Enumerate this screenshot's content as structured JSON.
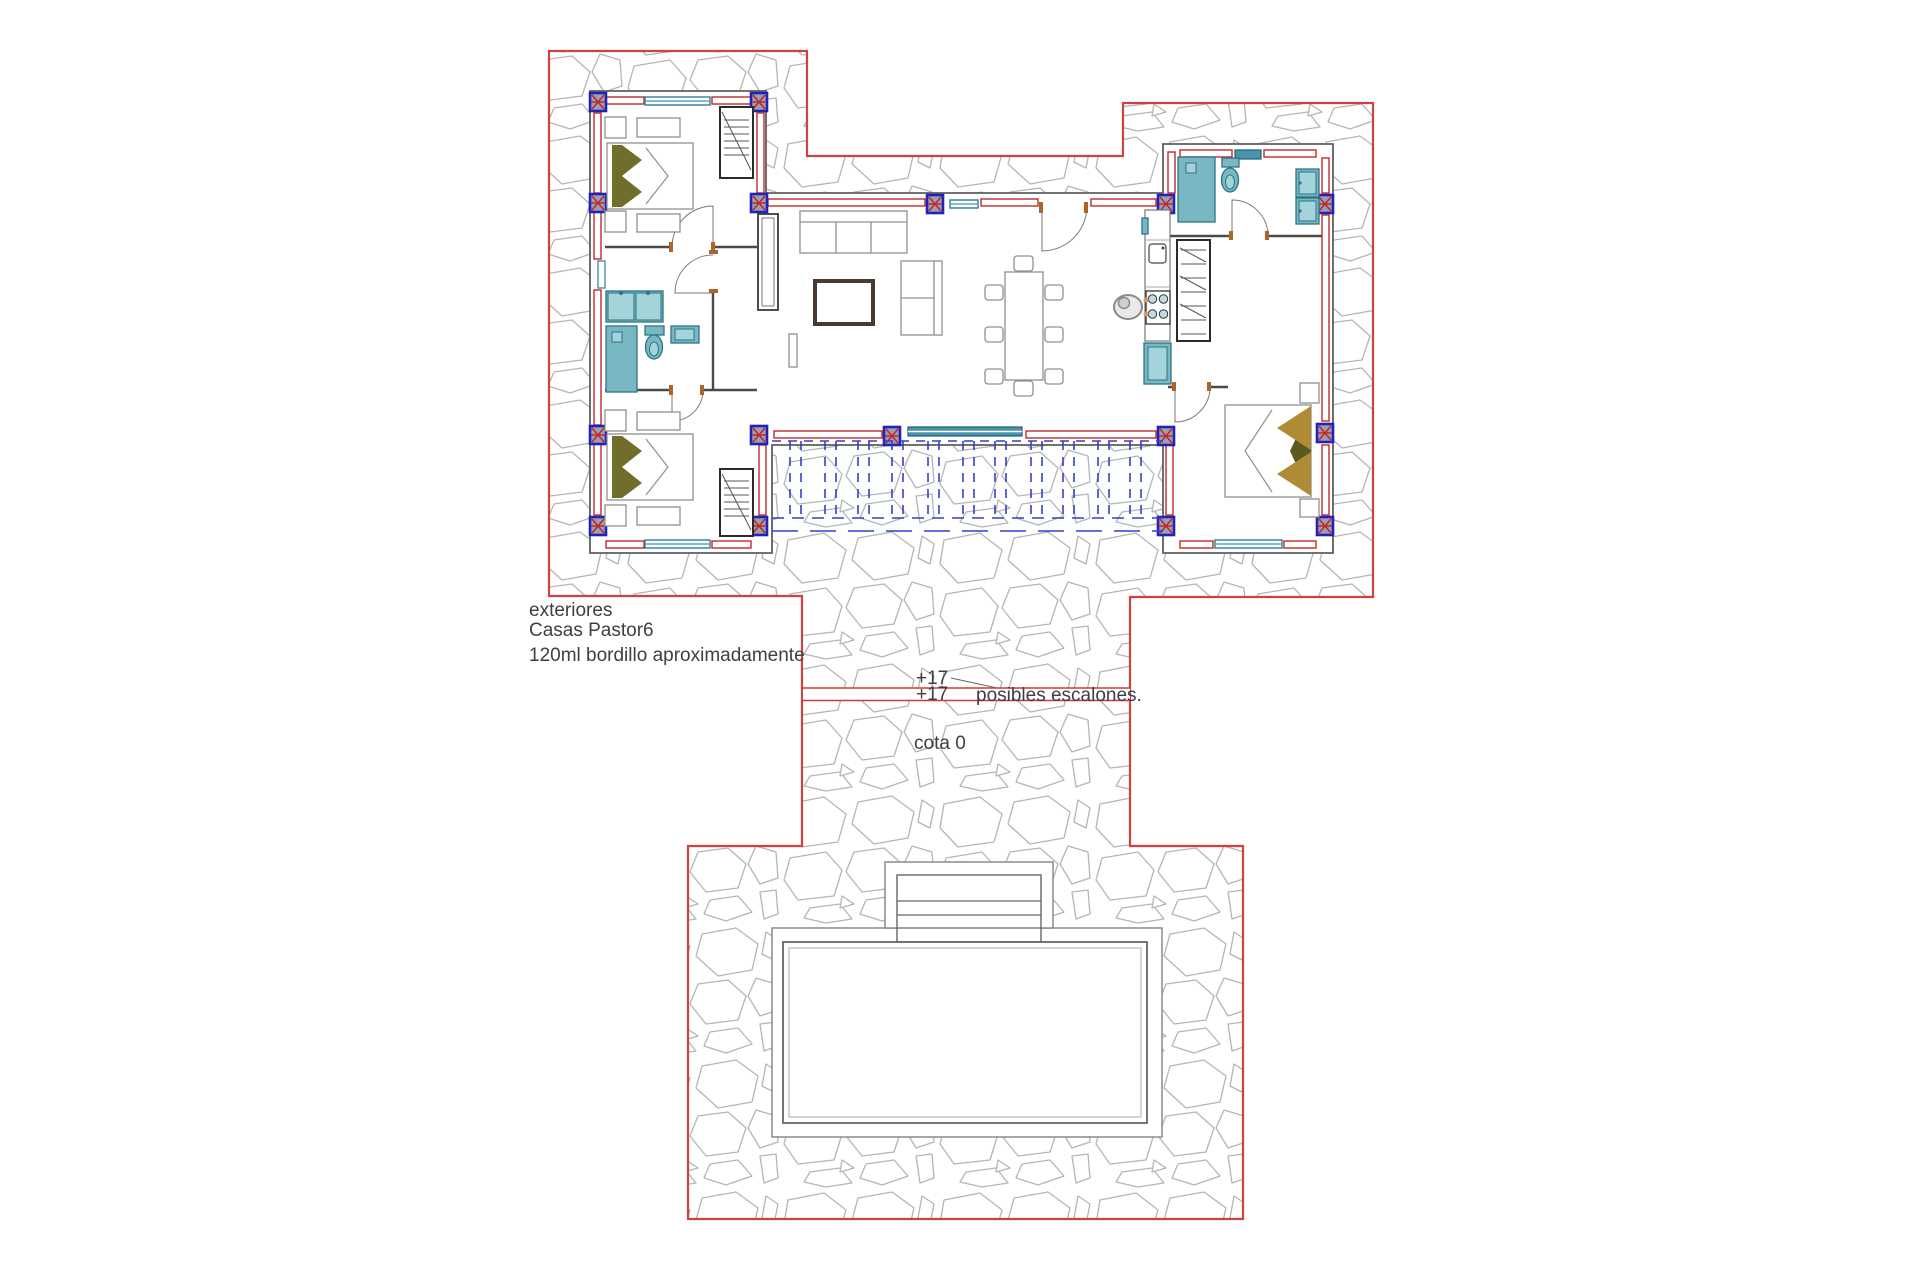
{
  "annotations": {
    "exteriores": "exteriores",
    "project_name": "Casas Pastor6",
    "curb_note": "120ml bordillo aproximadamente",
    "level_above": "+17",
    "level_below": "+17",
    "steps_note": "posibles escalones.",
    "datum_note": "cota 0"
  },
  "colors": {
    "boundary_red": "#cf4242",
    "wall_red": "#c32828",
    "pillar_blue": "#2222bb",
    "fixture_teal": "#79b7c3",
    "pergola_blue": "#3140cc",
    "stone_joint_gray": "#b5b5b5",
    "door_wood_brown": "#a9662a",
    "pillow_olive_green": "#6f6f2b",
    "bed_tan_brown": "#b18a36",
    "annotation_text": "#3f3f3f"
  }
}
